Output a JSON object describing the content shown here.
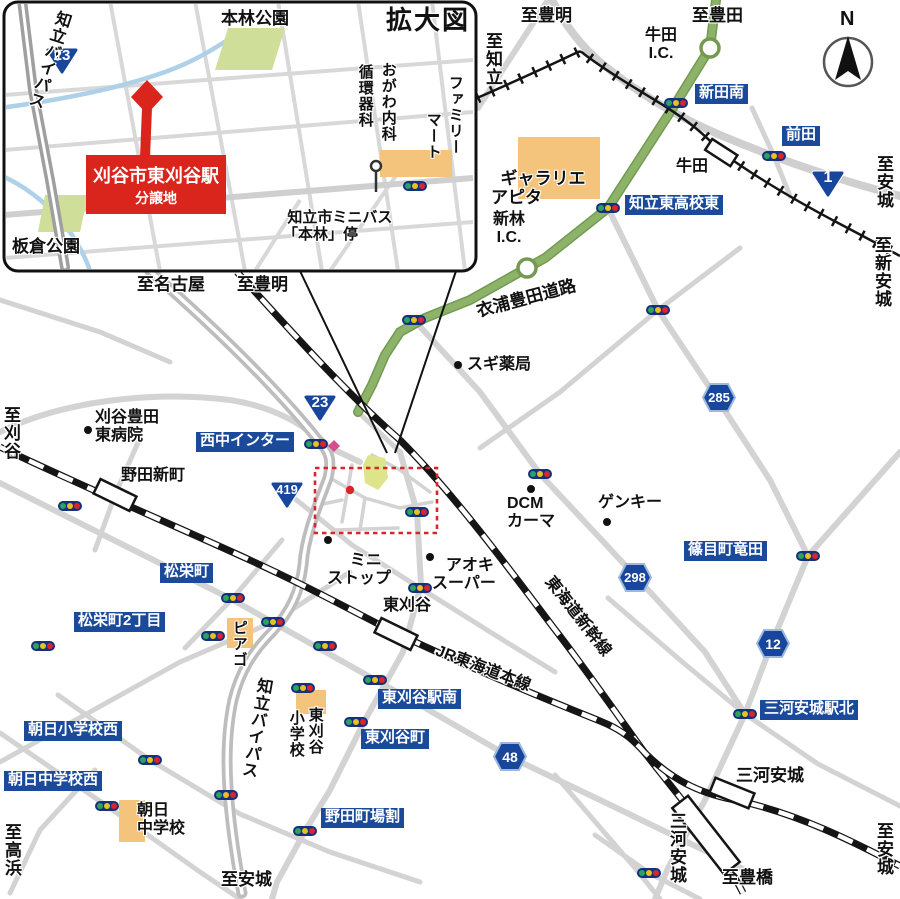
{
  "inset": {
    "title": "拡大図",
    "site_line1": "刈谷市東刈谷駅",
    "site_line2": "分譲地",
    "motobayashi_park": "本林公園",
    "itakura_park": "板倉公園",
    "chiryu_bypass": "知立バイパス",
    "ogawa_col1": "おがわ内科",
    "ogawa_col2": "循環器科",
    "famima_col1": "ファミリー",
    "famima_col2": "マート",
    "minibus_line1": "知立市ミニバス",
    "minibus_line2": "「本林」停",
    "to_nagoya": "至名古屋",
    "to_toyoake": "至豊明"
  },
  "map": {
    "to_toyoake_top": "至豊明",
    "to_chiryu": "至知立",
    "to_toyota": "至豊田",
    "ushida_ic": "牛田\nI.C.",
    "nitta_minami": "新田南",
    "maeda": "前田",
    "ushida_sta": "牛田",
    "to_anjo_ne": "至安城",
    "to_shin_anjo": "至新安城",
    "gallerie_line1": "ギャラリエ",
    "gallerie_line2": "アピタ",
    "chiryu_higashi_koko_higashi": "知立東高校東",
    "shinbayashi_ic": "新林\nI.C.",
    "kinuura_toyota_road": "衣浦豊田道路",
    "sugi_yakkyoku": "スギ薬局",
    "kariya_toyota_hospital": "刈谷豊田\n東病院",
    "to_kariya": "至刈谷",
    "nishinaka_inter": "西中インター",
    "noda_shinmachi": "野田新町",
    "dcm_kahma": "DCM\nカーマ",
    "genky": "ゲンキー",
    "sasame_cho_tatsuta": "篠目町竜田",
    "ministop_line1": "ミニ",
    "ministop_line2": "ストップ",
    "aoki_line1": "アオキ",
    "aoki_line2": "スーパー",
    "higashi_kariya_sta": "東刈谷",
    "jr_tokaido_line": "JR東海道本線",
    "tokaido_shinkansen": "東海道新幹線",
    "shoei_cho": "松栄町",
    "shoei_cho_2": "松栄町2丁目",
    "piago": "ピアゴ",
    "chiryu_bypass": "知立バイパス",
    "asahi_sho_nishi": "朝日小学校西",
    "asahi_chu_nishi": "朝日中学校西",
    "asahi_chu": "朝日\n中学校",
    "to_takahama": "至高浜",
    "to_anjo_south": "至安城",
    "higashi_kariya_eki_minami": "東刈谷駅南",
    "higashi_kariya_cho": "東刈谷町",
    "noda_cho_babari": "野田町場割",
    "hk_shogakko_col1": "東刈谷",
    "hk_shogakko_col2": "小学校",
    "mikawa_anjo_eki_kita": "三河安城駅北",
    "mikawa_anjo_jr": "三河安城",
    "mikawa_anjo_shinkansen": "三河安城",
    "to_toyohashi": "至豊橋",
    "to_anjo_se": "至安城"
  },
  "shields": {
    "r23_inset": "23",
    "r23": "23",
    "r419": "419",
    "r1": "1",
    "h285": "285",
    "h298": "298",
    "h12": "12",
    "h48": "48"
  },
  "compass": {
    "n": "N"
  },
  "colors": {
    "label_blue": "#1b4a9b",
    "site_red": "#da251d",
    "toll_green": "#8cb369",
    "road_gray": "#d3d3d3",
    "building_orange": "#f4c47c",
    "park_green": "#cfdf9a",
    "river_blue": "#aed0e8"
  }
}
